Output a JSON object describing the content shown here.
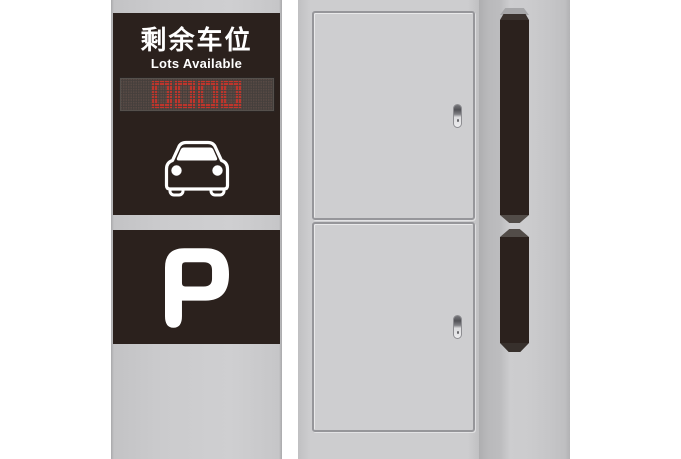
{
  "product": {
    "name": "parking-guidance-sign-pillar",
    "views": [
      "front",
      "back",
      "side"
    ]
  },
  "front_sign": {
    "title_cn": "剩余车位",
    "title_en": "Lots Available",
    "led_value": "0000",
    "p_symbol": "P",
    "icons": [
      "led-display",
      "car-front-icon",
      "parking-p-icon"
    ]
  },
  "cabinet": {
    "door_count": 2,
    "handle_icon": "door-handle-icon"
  },
  "side_view": {
    "panel_count": 2
  },
  "colors": {
    "background": "#ffffff",
    "pillar_gray": "#c8c8ca",
    "panel_dark": "#2b211d",
    "led_background": "#453f3c",
    "led_red": "#d2342a",
    "cabinet_gray": "#cdcdcf",
    "door_frame_gray": "#96969a",
    "text_white": "#ffffff"
  }
}
